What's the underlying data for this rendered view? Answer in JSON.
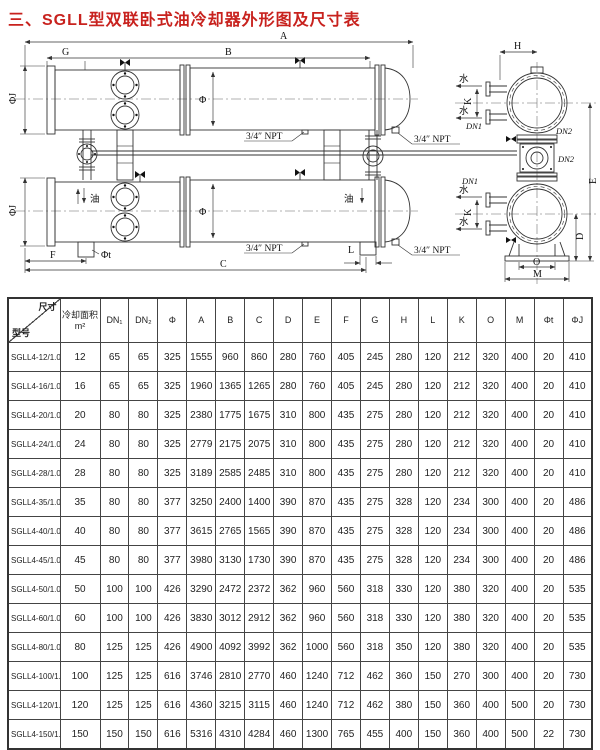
{
  "page": {
    "title": "三、SGLL型双联卧式油冷却器外形图及尺寸表"
  },
  "drawing": {
    "labels": {
      "A": "A",
      "B": "B",
      "G": "G",
      "C": "C",
      "F": "F",
      "L": "L",
      "H": "H",
      "K": "K",
      "E": "E",
      "D": "D",
      "O": "O",
      "M": "M",
      "phi": "Φ",
      "phiJ": "ΦJ",
      "phiT": "Φt",
      "npt": "3/4″ NPT",
      "oil": "油",
      "water": "水",
      "dn1": "DN1",
      "dn2": "DN2"
    }
  },
  "table": {
    "corner": {
      "top": "尺寸",
      "bottom": "型号"
    },
    "columns": [
      "冷却面积\nm²",
      "DN₁",
      "DN₂",
      "Φ",
      "A",
      "B",
      "C",
      "D",
      "E",
      "F",
      "G",
      "H",
      "L",
      "K",
      "O",
      "M",
      "Φt",
      "ΦJ"
    ],
    "rows": [
      {
        "model": "SGLL4-12/1.0",
        "values": [
          "12",
          "65",
          "65",
          "325",
          "1555",
          "960",
          "860",
          "280",
          "760",
          "405",
          "245",
          "280",
          "120",
          "212",
          "320",
          "400",
          "20",
          "410"
        ]
      },
      {
        "model": "SGLL4-16/1.0",
        "values": [
          "16",
          "65",
          "65",
          "325",
          "1960",
          "1365",
          "1265",
          "280",
          "760",
          "405",
          "245",
          "280",
          "120",
          "212",
          "320",
          "400",
          "20",
          "410"
        ]
      },
      {
        "model": "SGLL4-20/1.0",
        "values": [
          "20",
          "80",
          "80",
          "325",
          "2380",
          "1775",
          "1675",
          "310",
          "800",
          "435",
          "275",
          "280",
          "120",
          "212",
          "320",
          "400",
          "20",
          "410"
        ]
      },
      {
        "model": "SGLL4-24/1.0",
        "values": [
          "24",
          "80",
          "80",
          "325",
          "2779",
          "2175",
          "2075",
          "310",
          "800",
          "435",
          "275",
          "280",
          "120",
          "212",
          "320",
          "400",
          "20",
          "410"
        ]
      },
      {
        "model": "SGLL4-28/1.0",
        "values": [
          "28",
          "80",
          "80",
          "325",
          "3189",
          "2585",
          "2485",
          "310",
          "800",
          "435",
          "275",
          "280",
          "120",
          "212",
          "320",
          "400",
          "20",
          "410"
        ]
      },
      {
        "model": "SGLL4-35/1.0",
        "values": [
          "35",
          "80",
          "80",
          "377",
          "3250",
          "2400",
          "1400",
          "390",
          "870",
          "435",
          "275",
          "328",
          "120",
          "234",
          "300",
          "400",
          "20",
          "486"
        ]
      },
      {
        "model": "SGLL4-40/1.0",
        "values": [
          "40",
          "80",
          "80",
          "377",
          "3615",
          "2765",
          "1565",
          "390",
          "870",
          "435",
          "275",
          "328",
          "120",
          "234",
          "300",
          "400",
          "20",
          "486"
        ]
      },
      {
        "model": "SGLL4-45/1.0",
        "values": [
          "45",
          "80",
          "80",
          "377",
          "3980",
          "3130",
          "1730",
          "390",
          "870",
          "435",
          "275",
          "328",
          "120",
          "234",
          "300",
          "400",
          "20",
          "486"
        ]
      },
      {
        "model": "SGLL4-50/1.0",
        "values": [
          "50",
          "100",
          "100",
          "426",
          "3290",
          "2472",
          "2372",
          "362",
          "960",
          "560",
          "318",
          "330",
          "120",
          "380",
          "320",
          "400",
          "20",
          "535"
        ]
      },
      {
        "model": "SGLL4-60/1.0",
        "values": [
          "60",
          "100",
          "100",
          "426",
          "3830",
          "3012",
          "2912",
          "362",
          "960",
          "560",
          "318",
          "330",
          "120",
          "380",
          "320",
          "400",
          "20",
          "535"
        ]
      },
      {
        "model": "SGLL4-80/1.0",
        "values": [
          "80",
          "125",
          "125",
          "426",
          "4900",
          "4092",
          "3992",
          "362",
          "1000",
          "560",
          "318",
          "350",
          "120",
          "380",
          "320",
          "400",
          "20",
          "535"
        ]
      },
      {
        "model": "SGLL4-100/1.0",
        "values": [
          "100",
          "125",
          "125",
          "616",
          "3746",
          "2810",
          "2770",
          "460",
          "1240",
          "712",
          "462",
          "360",
          "150",
          "270",
          "300",
          "400",
          "20",
          "730"
        ]
      },
      {
        "model": "SGLL4-120/1.0",
        "values": [
          "120",
          "125",
          "125",
          "616",
          "4360",
          "3215",
          "3115",
          "460",
          "1240",
          "712",
          "462",
          "380",
          "150",
          "360",
          "400",
          "500",
          "20",
          "730"
        ]
      },
      {
        "model": "SGLL4-150/1.0",
        "values": [
          "150",
          "150",
          "150",
          "616",
          "5316",
          "4310",
          "4284",
          "460",
          "1300",
          "765",
          "455",
          "400",
          "150",
          "360",
          "400",
          "500",
          "22",
          "730"
        ]
      }
    ]
  }
}
